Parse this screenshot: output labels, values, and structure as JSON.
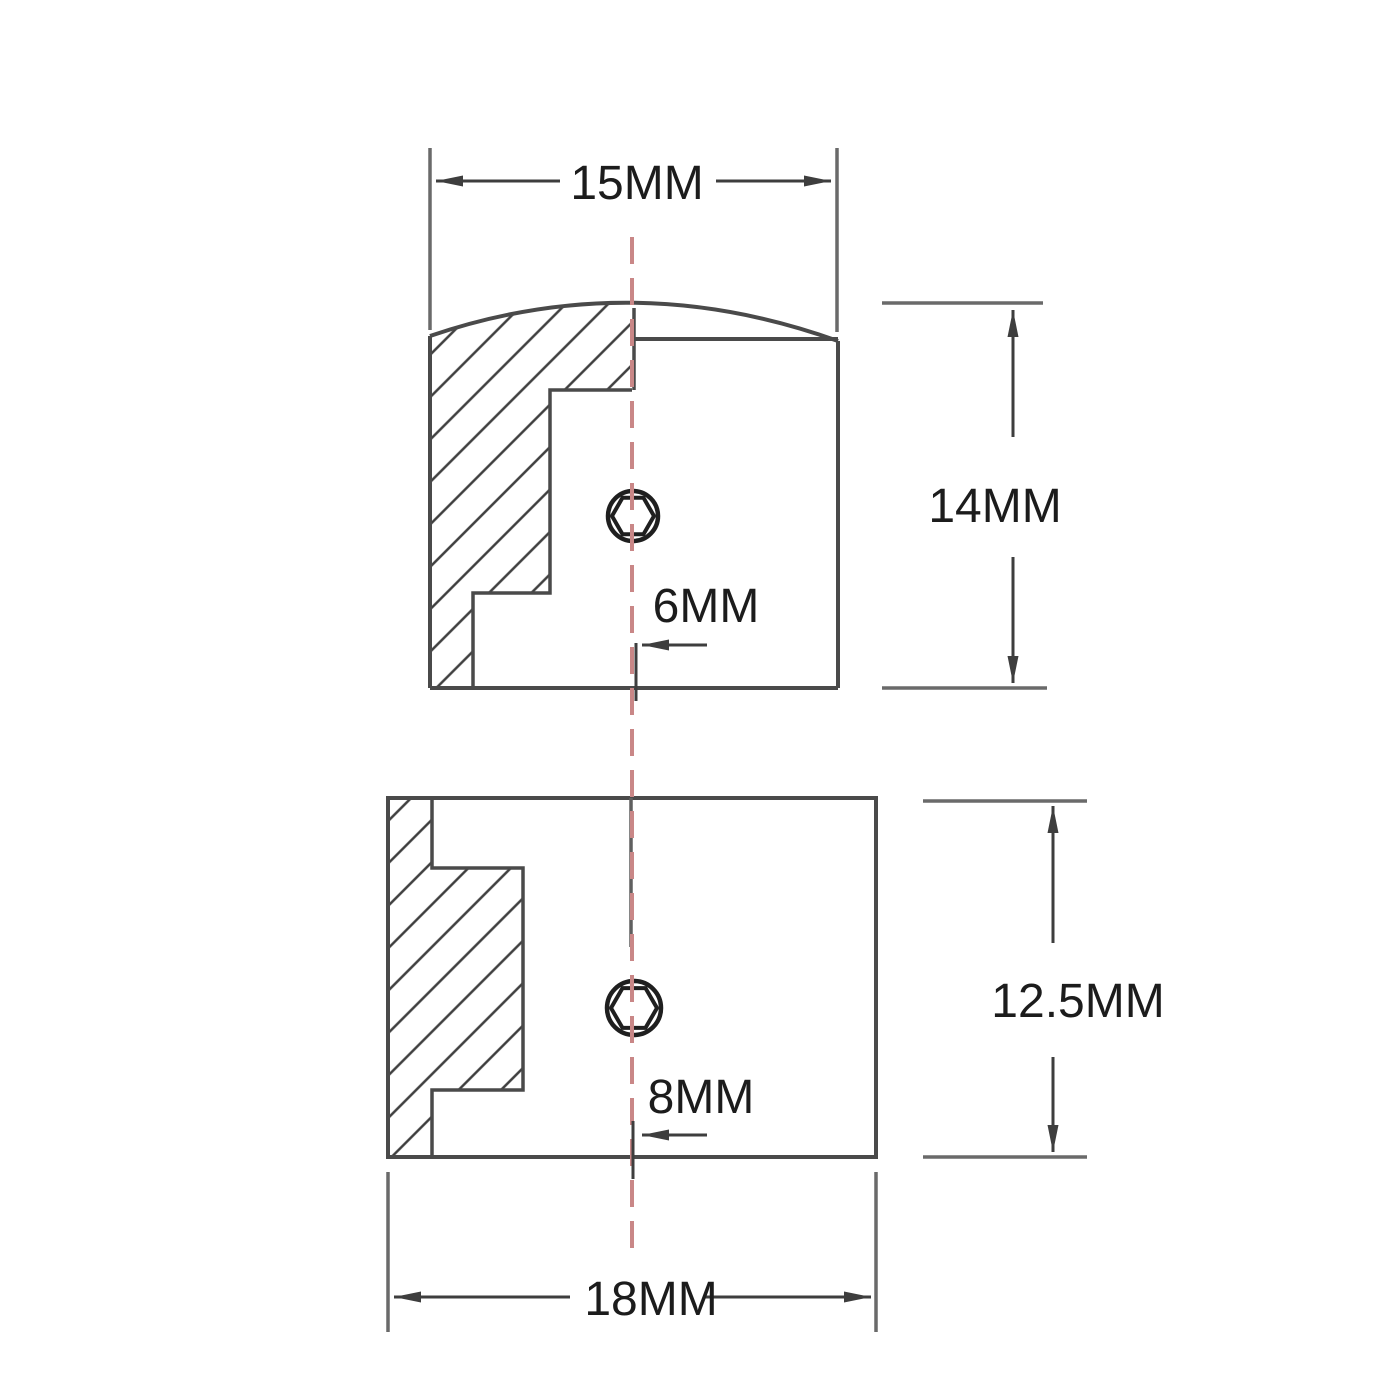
{
  "drawing": {
    "type": "half-section technical drawing, two knob side views",
    "units": "MM",
    "top_view": {
      "description": "dome-top knob cross-section",
      "width": "15MM",
      "height": "14MM",
      "bore": "6MM"
    },
    "bottom_view": {
      "description": "flat-top knob cross-section",
      "width": "18MM",
      "height": "12.5MM",
      "bore": "8MM"
    },
    "colors": {
      "outline": "#4a4a4a",
      "dimension_lines": "#3e3e3e",
      "extension_lines": "#6a6a6a",
      "hatch": "#3f3f3f",
      "hole_outline": "#1f1f1f",
      "label_text": "#1c1c1c",
      "centerline_red": "#c98787",
      "background": "#ffffff"
    }
  }
}
